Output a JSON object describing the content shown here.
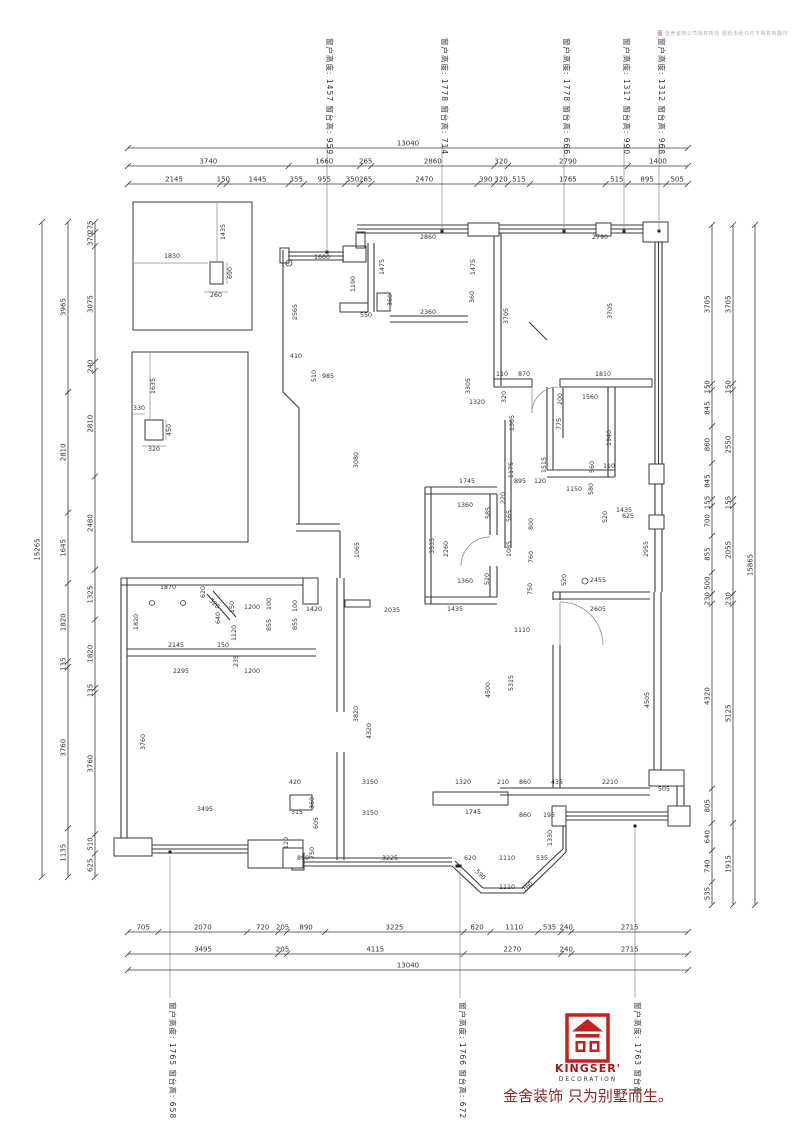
{
  "drawing": {
    "copyright": "金舍装饰公司版权所有·图纸未经许可不得复制翻印",
    "copyright_mark": "图",
    "window_annotations": {
      "top": [
        {
          "text": "窗户高度: 1457 窗台高: 959",
          "x": 327
        },
        {
          "text": "窗户高度: 1778 窗台高: 714",
          "x": 442
        },
        {
          "text": "窗户高度: 1778 窗台高: 666",
          "x": 564
        },
        {
          "text": "窗户高度: 1317 窗台高: 990",
          "x": 624
        },
        {
          "text": "窗户高度: 1312 窗台高: 968",
          "x": 659
        }
      ],
      "bottom": [
        {
          "text": "窗户高度: 1765 窗台高: 658",
          "x": 170
        },
        {
          "text": "窗户高度: 1766 窗台高: 672",
          "x": 460
        },
        {
          "text": "窗户高度: 1763 窗台高:",
          "x": 635
        }
      ]
    },
    "dim_chains": [
      {
        "id": "top-total",
        "dir": "h",
        "line": 148,
        "from": 128,
        "to": 688,
        "values": [
          13040
        ]
      },
      {
        "id": "top-row2",
        "dir": "h",
        "line": 166,
        "from": 128,
        "to": 688,
        "values": [
          3740,
          1660,
          265,
          2860,
          320,
          2790,
          1400
        ]
      },
      {
        "id": "top-row3",
        "dir": "h",
        "line": 184,
        "from": 128,
        "to": 688,
        "values": [
          2145,
          150,
          1445,
          355,
          955,
          350,
          265,
          2470,
          390,
          320,
          515,
          1765,
          515,
          895,
          505
        ]
      },
      {
        "id": "bottom-row1",
        "dir": "h",
        "line": 932,
        "from": 128,
        "to": 688,
        "values": [
          705,
          2070,
          720,
          205,
          890,
          3225,
          620,
          1110,
          535,
          240,
          2715
        ]
      },
      {
        "id": "bottom-row2",
        "dir": "h",
        "line": 954,
        "from": 128,
        "to": 688,
        "values": [
          3495,
          205,
          4115,
          2270,
          240,
          2715
        ]
      },
      {
        "id": "bottom-total",
        "dir": "h",
        "line": 970,
        "from": 128,
        "to": 688,
        "values": [
          13040
        ]
      },
      {
        "id": "left-total",
        "dir": "v",
        "line": 42,
        "from": 222,
        "to": 877,
        "values": [
          15265
        ]
      },
      {
        "id": "left-mid",
        "dir": "v",
        "line": 68,
        "from": 222,
        "to": 877,
        "values": [
          3965,
          2810,
          1645,
          1820,
          135,
          3760,
          1135
        ]
      },
      {
        "id": "left-inner",
        "dir": "v",
        "line": 95,
        "from": 222,
        "to": 877,
        "values": [
          275,
          370,
          3075,
          240,
          2810,
          2480,
          1325,
          1820,
          135,
          3760,
          510,
          625
        ]
      },
      {
        "id": "right-inner",
        "dir": "v",
        "line": 712,
        "from": 225,
        "to": 905,
        "values": [
          3705,
          150,
          845,
          860,
          845,
          155,
          700,
          855,
          500,
          230,
          4320,
          805,
          640,
          740,
          535
        ]
      },
      {
        "id": "right-mid",
        "dir": "v",
        "line": 733,
        "from": 225,
        "to": 905,
        "values": [
          3705,
          150,
          2550,
          155,
          2055,
          230,
          5125,
          1915
        ]
      },
      {
        "id": "right-total",
        "dir": "v",
        "line": 755,
        "from": 225,
        "to": 905,
        "values": [
          15865
        ]
      }
    ],
    "interior_labels": [
      [
        "1435",
        225,
        232,
        -90
      ],
      [
        "1830",
        172,
        258,
        0
      ],
      [
        "690",
        232,
        273,
        -90
      ],
      [
        "260",
        216,
        297,
        0
      ],
      [
        "1635",
        155,
        386,
        -90
      ],
      [
        "330",
        139,
        410,
        0
      ],
      [
        "450",
        171,
        430,
        -90
      ],
      [
        "320",
        154,
        451,
        0
      ],
      [
        "1660",
        322,
        259,
        0
      ],
      [
        "2860",
        428,
        239,
        0
      ],
      [
        "2790",
        600,
        239,
        0
      ],
      [
        "1475",
        384,
        267,
        -90
      ],
      [
        "1475",
        475,
        267,
        -90
      ],
      [
        "1190",
        355,
        284,
        -90
      ],
      [
        "360",
        392,
        300,
        -90
      ],
      [
        "360",
        474,
        297,
        -90
      ],
      [
        "550",
        366,
        317,
        0
      ],
      [
        "2360",
        428,
        314,
        0
      ],
      [
        "2565",
        297,
        312,
        -90
      ],
      [
        "3705",
        508,
        316,
        -90
      ],
      [
        "3705",
        612,
        311,
        -90
      ],
      [
        "410",
        296,
        358,
        0
      ],
      [
        "510",
        316,
        376,
        -90
      ],
      [
        "985",
        328,
        378,
        0
      ],
      [
        "3080",
        358,
        460,
        -90
      ],
      [
        "1065",
        359,
        550,
        -90
      ],
      [
        "3305",
        470,
        386,
        -90
      ],
      [
        "1320",
        477,
        404,
        0
      ],
      [
        "320",
        506,
        397,
        -90
      ],
      [
        "110",
        502,
        376,
        0
      ],
      [
        "870",
        524,
        376,
        0
      ],
      [
        "1810",
        603,
        376,
        0
      ],
      [
        "200",
        562,
        399,
        -90
      ],
      [
        "1560",
        590,
        399,
        0
      ],
      [
        "1305",
        514,
        423,
        -90
      ],
      [
        "775",
        561,
        424,
        -90
      ],
      [
        "1940",
        611,
        438,
        -90
      ],
      [
        "560",
        594,
        467,
        -90
      ],
      [
        "625",
        628,
        518,
        0
      ],
      [
        "1175",
        513,
        470,
        -90
      ],
      [
        "1515",
        546,
        465,
        -90
      ],
      [
        "1150",
        574,
        491,
        0
      ],
      [
        "580",
        593,
        489,
        -90
      ],
      [
        "110",
        609,
        468,
        0
      ],
      [
        "1435",
        624,
        512,
        0
      ],
      [
        "520",
        607,
        517,
        -90
      ],
      [
        "2955",
        648,
        549,
        -90
      ],
      [
        "2455",
        598,
        582,
        0
      ],
      [
        "520",
        566,
        580,
        -90
      ],
      [
        "750",
        532,
        589,
        -90
      ],
      [
        "2605",
        598,
        611,
        0
      ],
      [
        "1110",
        522,
        632,
        0
      ],
      [
        "5315",
        513,
        683,
        -90
      ],
      [
        "4505",
        649,
        700,
        -90
      ],
      [
        "2210",
        610,
        784,
        0
      ],
      [
        "505",
        664,
        791,
        0
      ],
      [
        "860",
        525,
        817,
        0
      ],
      [
        "195",
        549,
        817,
        0
      ],
      [
        "1745",
        467,
        483,
        0
      ],
      [
        "895",
        520,
        483,
        0
      ],
      [
        "120",
        540,
        483,
        0
      ],
      [
        "1360",
        465,
        507,
        0
      ],
      [
        "585",
        490,
        513,
        -90
      ],
      [
        "565",
        511,
        516,
        -90
      ],
      [
        "220",
        505,
        498,
        -90
      ],
      [
        "2260",
        448,
        549,
        -90
      ],
      [
        "1085",
        511,
        549,
        -90
      ],
      [
        "3535",
        434,
        546,
        -90
      ],
      [
        "800",
        533,
        524,
        -90
      ],
      [
        "760",
        533,
        557,
        -90
      ],
      [
        "1360",
        465,
        583,
        0
      ],
      [
        "520",
        489,
        579,
        -90
      ],
      [
        "2035",
        392,
        612,
        0
      ],
      [
        "1435",
        455,
        611,
        0
      ],
      [
        "1420",
        314,
        611,
        0
      ],
      [
        "1870",
        168,
        589,
        0
      ],
      [
        "620",
        205,
        592,
        -90
      ],
      [
        "520",
        213,
        605,
        45
      ],
      [
        "640",
        220,
        618,
        -90
      ],
      [
        "150",
        234,
        607,
        -90
      ],
      [
        "1200",
        252,
        609,
        0
      ],
      [
        "100",
        271,
        604,
        -90
      ],
      [
        "100",
        297,
        606,
        -90
      ],
      [
        "855",
        271,
        625,
        -90
      ],
      [
        "855",
        297,
        624,
        -90
      ],
      [
        "1120",
        236,
        633,
        -90
      ],
      [
        "1820",
        138,
        622,
        -90
      ],
      [
        "2145",
        176,
        647,
        0
      ],
      [
        "150",
        223,
        647,
        0
      ],
      [
        "235",
        238,
        661,
        -90
      ],
      [
        "2295",
        181,
        673,
        0
      ],
      [
        "1200",
        252,
        673,
        0
      ],
      [
        "3760",
        145,
        742,
        -90
      ],
      [
        "3820",
        358,
        714,
        -90
      ],
      [
        "4320",
        371,
        731,
        -90
      ],
      [
        "4500",
        490,
        690,
        -90
      ],
      [
        "3495",
        205,
        811,
        0
      ],
      [
        "420",
        295,
        784,
        0
      ],
      [
        "3150",
        370,
        784,
        0
      ],
      [
        "1320",
        463,
        784,
        0
      ],
      [
        "210",
        503,
        784,
        0
      ],
      [
        "860",
        525,
        784,
        0
      ],
      [
        "435",
        557,
        784,
        0
      ],
      [
        "360",
        314,
        803,
        -90
      ],
      [
        "315",
        297,
        814,
        0
      ],
      [
        "3150",
        370,
        815,
        0
      ],
      [
        "1745",
        473,
        814,
        0
      ],
      [
        "605",
        318,
        823,
        -90
      ],
      [
        "120",
        288,
        843,
        -90
      ],
      [
        "750",
        314,
        853,
        -90
      ],
      [
        "890",
        303,
        860,
        0
      ],
      [
        "3225",
        390,
        860,
        0
      ],
      [
        "620",
        470,
        860,
        0
      ],
      [
        "1110",
        507,
        860,
        0
      ],
      [
        "535",
        542,
        860,
        0
      ],
      [
        "590",
        479,
        876,
        45
      ],
      [
        "1110",
        507,
        889,
        0
      ],
      [
        "760",
        529,
        888,
        -45
      ],
      [
        "1330",
        552,
        838,
        -90
      ]
    ],
    "branding": {
      "logo_color": "#c3201f",
      "kingser": "KINGSER'",
      "decoration": "DECORATION",
      "slogan": "金舍装饰 只为别墅而生。"
    }
  }
}
